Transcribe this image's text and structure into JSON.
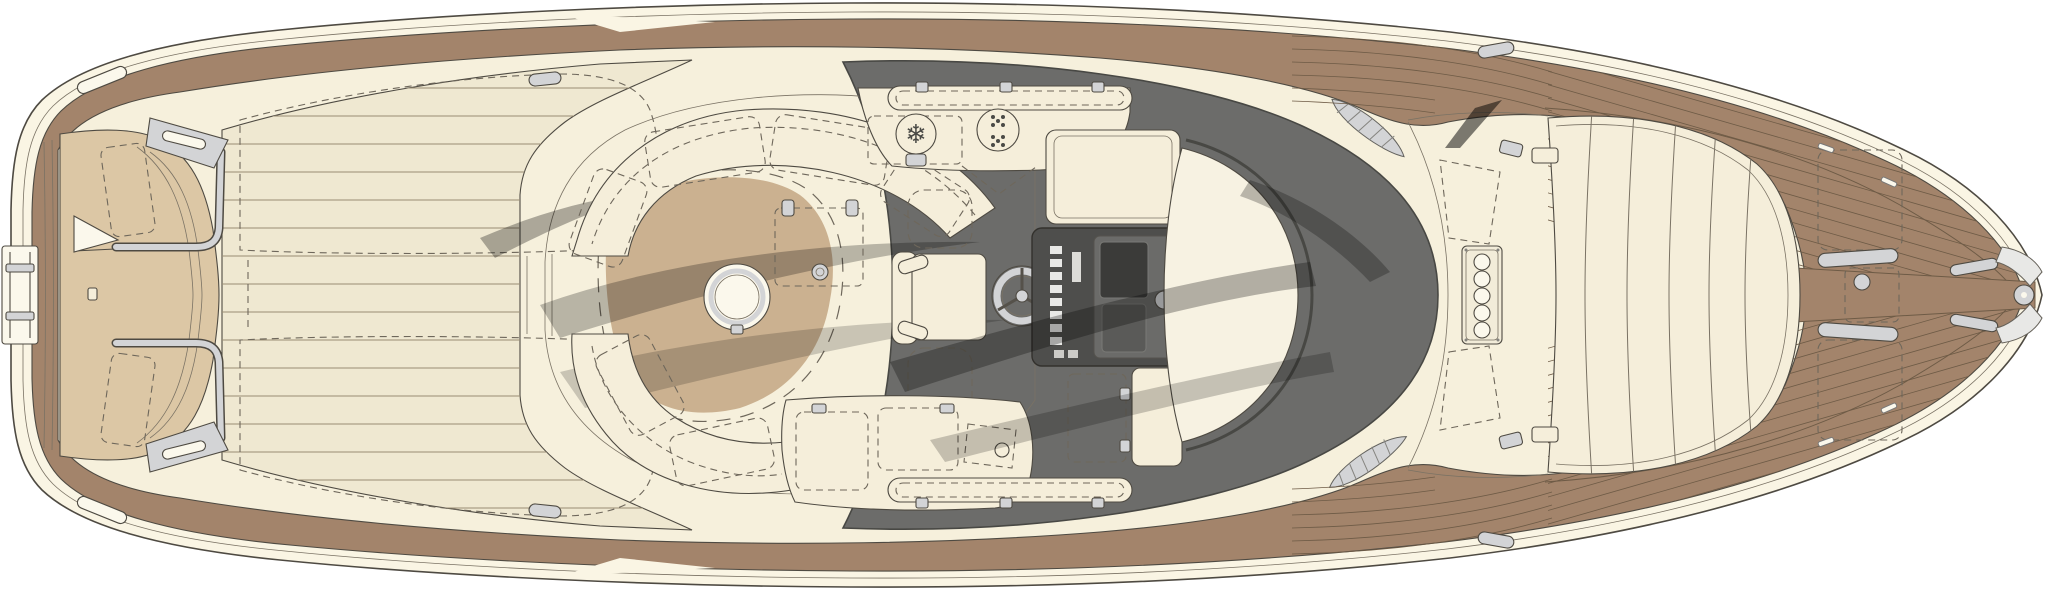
{
  "meta": {
    "title": "Luxury motor yacht deck plan — overhead view"
  },
  "icons": {
    "snowflake": "❄"
  },
  "palette": {
    "page_bg": "#FFFFFF",
    "hull_cream": "#FAF5E4",
    "teak_brown": "#A3846B",
    "teak_seam": "#6E5B46",
    "plank_seam": "#9A8D74",
    "deck_plank": "#EFE8D1",
    "interior_cream": "#F6F0DC",
    "floor_tan": "#DECAA9",
    "floor_tan_dark": "#CBB190",
    "sunpad_tan": "#DCC7A5",
    "furniture_cream": "#F5EEDA",
    "dome_cream": "#F7F2E2",
    "windshield_gray": "#6C6C6A",
    "windshield_frame": "#484844",
    "console_dark": "#4E4E4C",
    "console_panel": "#6B6B69",
    "metal_light": "#D3D4D6",
    "white_trim": "#FBF8EC",
    "outline": "#4E4A42",
    "line_soft": "#7A7264",
    "dash_line": "#6E675B"
  },
  "components": [
    {
      "id": "hull",
      "label": "Hull outline with rub rail"
    },
    {
      "id": "swim-ladder",
      "label": "Stern swim ladder"
    },
    {
      "id": "transom-sunpad",
      "label": "Transom sunpad with cushions"
    },
    {
      "id": "flag-staff",
      "label": "Ensign flag staff"
    },
    {
      "id": "grab-rails",
      "label": "Stainless grab rails"
    },
    {
      "id": "aft-deck",
      "label": "Planked aft deck with engine hatches"
    },
    {
      "id": "cockpit-sofa",
      "label": "Wraparound cockpit sofa"
    },
    {
      "id": "cocktail-table",
      "label": "Round cocktail table"
    },
    {
      "id": "folding-table",
      "label": "Stowed folding table"
    },
    {
      "id": "wet-bar",
      "label": "Wet bar with icemaker and burners"
    },
    {
      "id": "helm-seat",
      "label": "Helm seat"
    },
    {
      "id": "steering-wheel",
      "label": "Steering wheel"
    },
    {
      "id": "helm-console",
      "label": "Instrument console"
    },
    {
      "id": "aft-bench",
      "label": "Aft-facing bench lockers"
    },
    {
      "id": "windshield",
      "label": "Wraparound tinted windshield"
    },
    {
      "id": "soft-top",
      "label": "Soft-top dome over cabin"
    },
    {
      "id": "air-vents",
      "label": "Engine air vents"
    },
    {
      "id": "porthole-strip",
      "label": "Skylight strip with five portholes"
    },
    {
      "id": "bow-sunpad",
      "label": "Bow sunpad with six cushions"
    },
    {
      "id": "foredeck-teak",
      "label": "Teak foredeck with herringbone planks"
    },
    {
      "id": "anchor-locker",
      "label": "Anchor locker hatch"
    },
    {
      "id": "cleats",
      "label": "Mooring cleats"
    },
    {
      "id": "bow-fitting",
      "label": "Bow fairlead and roller"
    }
  ]
}
